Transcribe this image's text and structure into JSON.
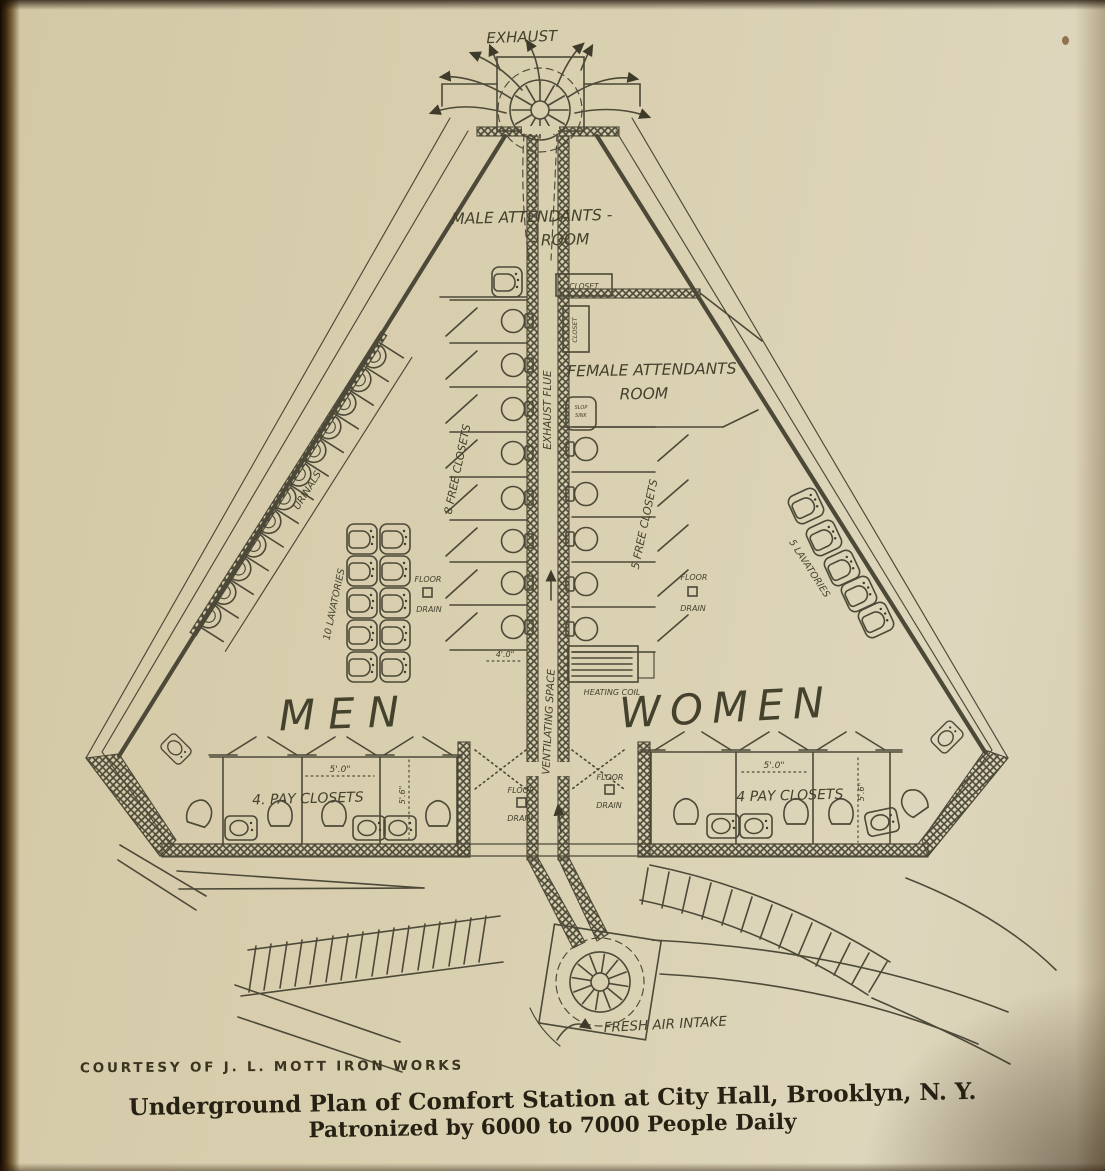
{
  "page": {
    "paper_color": "#d8cfae",
    "ink_color": "#4c4938",
    "caption_ink": "#272113"
  },
  "plan": {
    "exhaust_label": "EXHAUST",
    "fresh_air_label": "FRESH AIR INTAKE",
    "exhaust_flue_label": "EXHAUST FLUE",
    "ventilating_space_label": "VENTILATING SPACE",
    "heating_coil_label": "HEATING COIL",
    "male_attendants_line1": "MALE ATTENDANTS -",
    "male_attendants_line2": "- ROOM",
    "female_attendants_line1": "FEMALE ATTENDANTS",
    "female_attendants_line2": "ROOM",
    "closet_label": "CLOSET",
    "closet_vertical_label": "CLOSET",
    "slop_sink_line1": "SLOP",
    "slop_sink_line2": "SINK",
    "men_label": "MEN",
    "women_label": "WOMEN",
    "free_closets_left": "8 FREE  CLOSETS",
    "free_closets_right": "5 FREE  CLOSETS",
    "lavatories_left": "10 LAVATORIES",
    "lavatories_right": "5 LAVATORIES",
    "urinals_label": "URINALS",
    "pay_closets_left": "4. PAY  CLOSETS",
    "pay_closets_right": "4  PAY  CLOSETS",
    "floor_label": "FLOOR",
    "drain_label": "DRAIN",
    "dim_5ft": "5'.0\"",
    "dim_5ft6": "5'.6\"",
    "dim_4ft": "4'.0\""
  },
  "caption": {
    "courtesy": "COURTESY OF J. L. MOTT IRON WORKS",
    "title_line1": "Underground Plan of Comfort Station at City Hall, Brooklyn, N. Y.",
    "title_line2": "Patronized by 6000 to 7000 People Daily"
  }
}
